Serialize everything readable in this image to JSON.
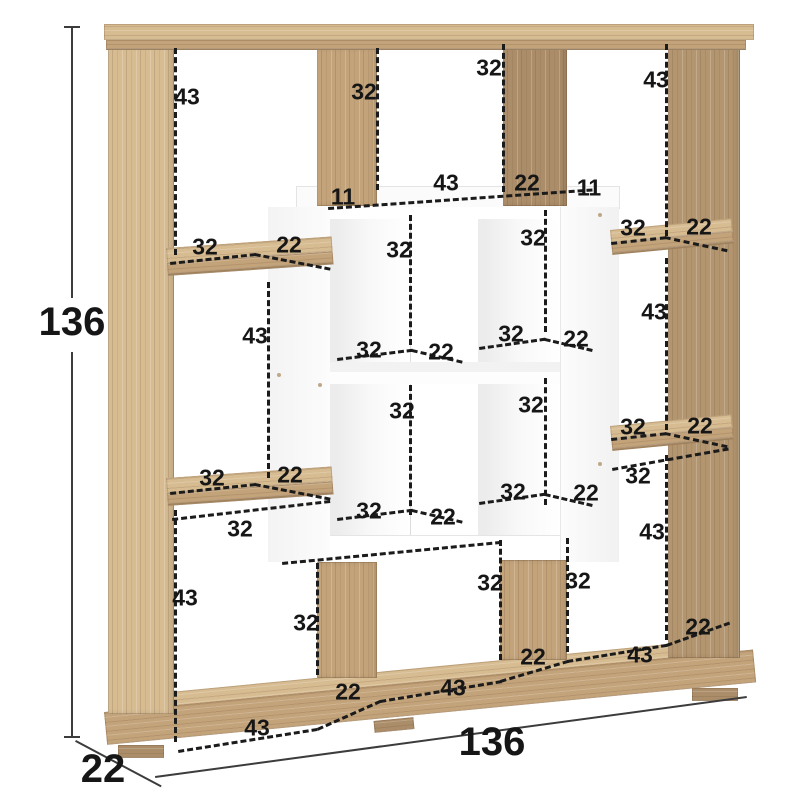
{
  "overall": {
    "height_label": "136",
    "width_label": "136",
    "depth_label": "22"
  },
  "colors": {
    "wood": "#c3a37a",
    "wood_light": "#d7bc92",
    "wood_dark": "#ab8d69",
    "panel": "#ffffff",
    "dash": "#1b1b1b",
    "dimline": "#3c3c3c",
    "bg": "#ffffff"
  },
  "annotations": [
    {
      "text": "43",
      "x": 187,
      "y": 97
    },
    {
      "text": "32",
      "x": 364,
      "y": 92
    },
    {
      "text": "32",
      "x": 489,
      "y": 68
    },
    {
      "text": "43",
      "x": 656,
      "y": 80
    },
    {
      "text": "11",
      "x": 343,
      "y": 197
    },
    {
      "text": "43",
      "x": 446,
      "y": 183
    },
    {
      "text": "22",
      "x": 527,
      "y": 183
    },
    {
      "text": "11",
      "x": 589,
      "y": 188
    },
    {
      "text": "32",
      "x": 205,
      "y": 247
    },
    {
      "text": "22",
      "x": 289,
      "y": 245
    },
    {
      "text": "43",
      "x": 255,
      "y": 336
    },
    {
      "text": "32",
      "x": 212,
      "y": 478
    },
    {
      "text": "22",
      "x": 290,
      "y": 475
    },
    {
      "text": "32",
      "x": 240,
      "y": 529
    },
    {
      "text": "32",
      "x": 633,
      "y": 228
    },
    {
      "text": "22",
      "x": 699,
      "y": 227
    },
    {
      "text": "43",
      "x": 654,
      "y": 312
    },
    {
      "text": "32",
      "x": 633,
      "y": 427
    },
    {
      "text": "22",
      "x": 700,
      "y": 426
    },
    {
      "text": "32",
      "x": 638,
      "y": 476
    },
    {
      "text": "32",
      "x": 399,
      "y": 250
    },
    {
      "text": "32",
      "x": 533,
      "y": 238
    },
    {
      "text": "32",
      "x": 369,
      "y": 350
    },
    {
      "text": "22",
      "x": 441,
      "y": 352
    },
    {
      "text": "32",
      "x": 511,
      "y": 334
    },
    {
      "text": "22",
      "x": 576,
      "y": 339
    },
    {
      "text": "32",
      "x": 402,
      "y": 411
    },
    {
      "text": "32",
      "x": 531,
      "y": 405
    },
    {
      "text": "32",
      "x": 369,
      "y": 511
    },
    {
      "text": "22",
      "x": 443,
      "y": 517
    },
    {
      "text": "32",
      "x": 513,
      "y": 492
    },
    {
      "text": "22",
      "x": 586,
      "y": 493
    },
    {
      "text": "32",
      "x": 306,
      "y": 623
    },
    {
      "text": "32",
      "x": 490,
      "y": 583
    },
    {
      "text": "32",
      "x": 578,
      "y": 581
    },
    {
      "text": "43",
      "x": 185,
      "y": 598
    },
    {
      "text": "22",
      "x": 348,
      "y": 692
    },
    {
      "text": "43",
      "x": 453,
      "y": 688
    },
    {
      "text": "22",
      "x": 533,
      "y": 657
    },
    {
      "text": "43",
      "x": 257,
      "y": 728
    },
    {
      "text": "43",
      "x": 640,
      "y": 655
    },
    {
      "text": "22",
      "x": 698,
      "y": 627
    },
    {
      "text": "43",
      "x": 652,
      "y": 532
    }
  ]
}
